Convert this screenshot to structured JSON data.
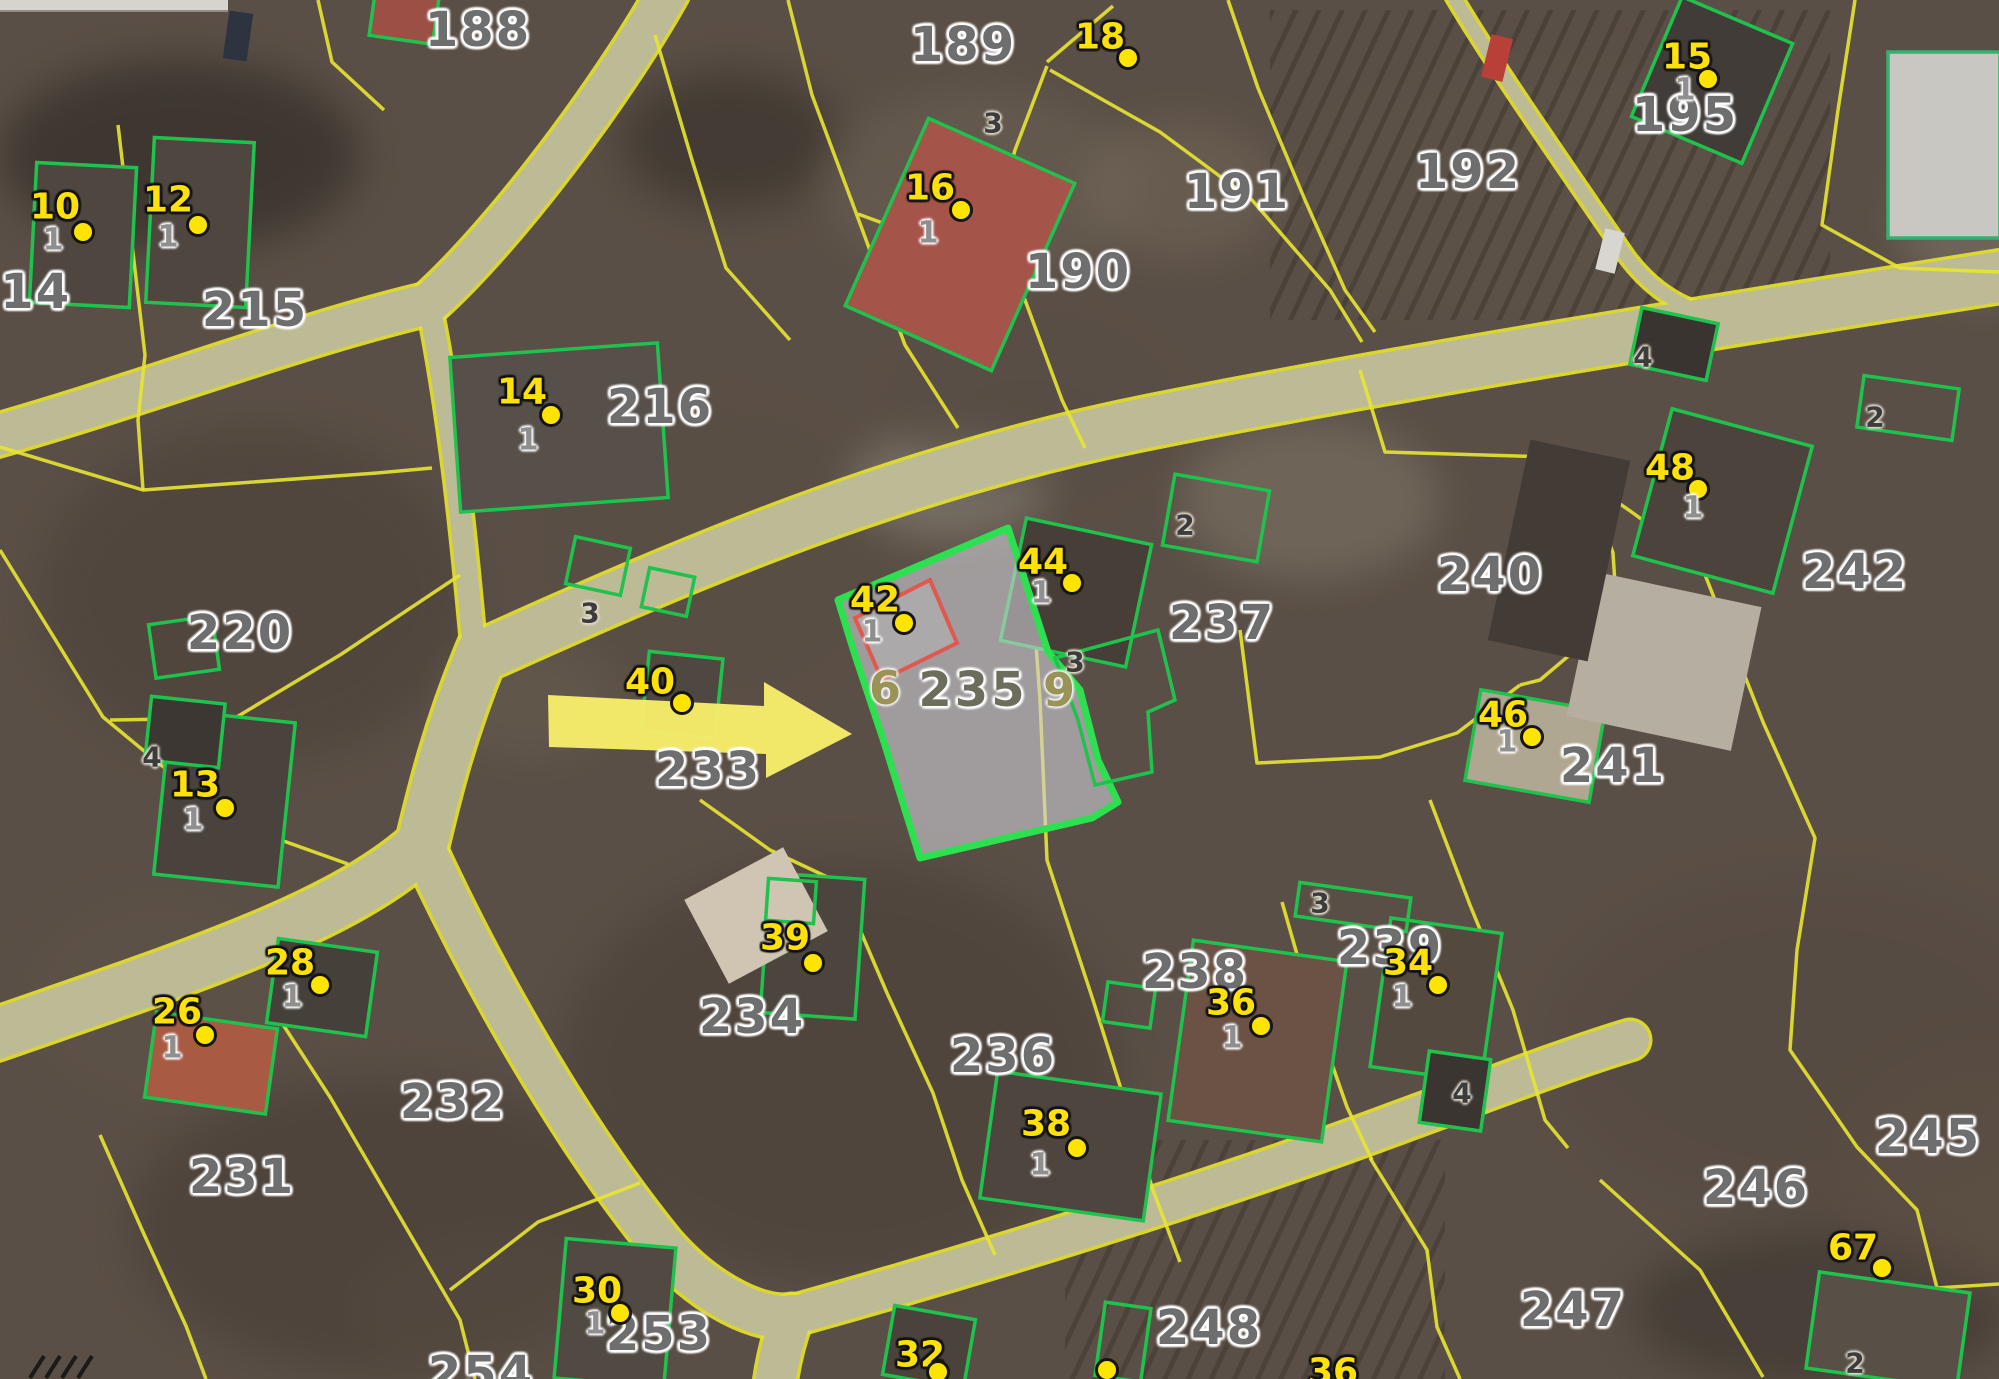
{
  "map": {
    "highlighted_parcel": {
      "number": "235",
      "ghost_left": "6",
      "ghost_right": "9",
      "x": 973,
      "y": 690
    },
    "parcel_labels": [
      {
        "text": "214",
        "x": 18,
        "y": 292
      },
      {
        "text": "215",
        "x": 255,
        "y": 310
      },
      {
        "text": "188",
        "x": 478,
        "y": 30
      },
      {
        "text": "189",
        "x": 963,
        "y": 45
      },
      {
        "text": "190",
        "x": 1078,
        "y": 272
      },
      {
        "text": "191",
        "x": 1237,
        "y": 192
      },
      {
        "text": "192",
        "x": 1468,
        "y": 172
      },
      {
        "text": "195",
        "x": 1685,
        "y": 115
      },
      {
        "text": "216",
        "x": 660,
        "y": 407
      },
      {
        "text": "220",
        "x": 240,
        "y": 633
      },
      {
        "text": "233",
        "x": 708,
        "y": 770
      },
      {
        "text": "237",
        "x": 1222,
        "y": 623
      },
      {
        "text": "240",
        "x": 1490,
        "y": 575
      },
      {
        "text": "241",
        "x": 1613,
        "y": 766
      },
      {
        "text": "242",
        "x": 1855,
        "y": 572
      },
      {
        "text": "232",
        "x": 453,
        "y": 1102
      },
      {
        "text": "231",
        "x": 242,
        "y": 1177
      },
      {
        "text": "234",
        "x": 752,
        "y": 1017
      },
      {
        "text": "236",
        "x": 1003,
        "y": 1056
      },
      {
        "text": "238",
        "x": 1195,
        "y": 972
      },
      {
        "text": "239",
        "x": 1390,
        "y": 948
      },
      {
        "text": "245",
        "x": 1928,
        "y": 1137
      },
      {
        "text": "246",
        "x": 1756,
        "y": 1188
      },
      {
        "text": "247",
        "x": 1573,
        "y": 1310
      },
      {
        "text": "248",
        "x": 1209,
        "y": 1328
      },
      {
        "text": "253",
        "x": 659,
        "y": 1334
      },
      {
        "text": "254",
        "x": 481,
        "y": 1374
      }
    ],
    "point_markers": [
      {
        "label": "10",
        "lx": 55,
        "ly": 207,
        "dx": 83,
        "dy": 232,
        "sub": "1",
        "sx": 53,
        "sy": 240
      },
      {
        "label": "12",
        "lx": 168,
        "ly": 200,
        "dx": 198,
        "dy": 225,
        "sub": "1",
        "sx": 168,
        "sy": 237
      },
      {
        "label": "13",
        "lx": 195,
        "ly": 785,
        "dx": 225,
        "dy": 808,
        "sub": "1",
        "sx": 193,
        "sy": 820
      },
      {
        "label": "14",
        "lx": 522,
        "ly": 392,
        "dx": 551,
        "dy": 415,
        "sub": "1",
        "sx": 528,
        "sy": 440
      },
      {
        "label": "15",
        "lx": 1687,
        "ly": 57,
        "dx": 1708,
        "dy": 79,
        "sub": "1",
        "sx": 1685,
        "sy": 90
      },
      {
        "label": "16",
        "lx": 930,
        "ly": 188,
        "dx": 961,
        "dy": 210,
        "sub": "1",
        "sx": 928,
        "sy": 233
      },
      {
        "label": "18",
        "lx": 1100,
        "ly": 37,
        "dx": 1128,
        "dy": 58
      },
      {
        "label": "26",
        "lx": 177,
        "ly": 1012,
        "dx": 205,
        "dy": 1035,
        "sub": "1",
        "sx": 172,
        "sy": 1048
      },
      {
        "label": "28",
        "lx": 290,
        "ly": 963,
        "dx": 320,
        "dy": 985,
        "sub": "1",
        "sx": 292,
        "sy": 997
      },
      {
        "label": "30",
        "lx": 597,
        "ly": 1291,
        "dx": 620,
        "dy": 1313,
        "sub": "1",
        "sx": 595,
        "sy": 1324
      },
      {
        "label": "32",
        "lx": 920,
        "ly": 1355,
        "dx": 938,
        "dy": 1372
      },
      {
        "label": "34",
        "lx": 1408,
        "ly": 963,
        "dx": 1438,
        "dy": 985,
        "sub": "1",
        "sx": 1402,
        "sy": 997
      },
      {
        "label": "36",
        "lx": 1231,
        "ly": 1003,
        "dx": 1261,
        "dy": 1026,
        "sub": "1",
        "sx": 1232,
        "sy": 1038
      },
      {
        "label": "36",
        "lx": 1333,
        "ly": 1372
      },
      {
        "label": "38",
        "lx": 1046,
        "ly": 1124,
        "dx": 1077,
        "dy": 1148,
        "sub": "1",
        "sx": 1040,
        "sy": 1165
      },
      {
        "label": "39",
        "lx": 785,
        "ly": 938,
        "dx": 813,
        "dy": 963
      },
      {
        "label": "40",
        "lx": 650,
        "ly": 682,
        "dx": 682,
        "dy": 703
      },
      {
        "label": "42",
        "lx": 875,
        "ly": 600,
        "dx": 904,
        "dy": 623,
        "sub": "1",
        "sx": 872,
        "sy": 632
      },
      {
        "label": "44",
        "lx": 1043,
        "ly": 562,
        "dx": 1072,
        "dy": 583,
        "sub": "1",
        "sx": 1041,
        "sy": 593
      },
      {
        "label": "46",
        "lx": 1503,
        "ly": 715,
        "dx": 1532,
        "dy": 737,
        "sub": "1",
        "sx": 1507,
        "sy": 742
      },
      {
        "label": "48",
        "lx": 1670,
        "ly": 468,
        "dx": 1698,
        "dy": 489,
        "sub": "1",
        "sx": 1693,
        "sy": 508
      },
      {
        "label": "67",
        "lx": 1853,
        "ly": 1248,
        "dx": 1882,
        "dy": 1268
      }
    ],
    "extra_dots": [
      {
        "x": 1107,
        "y": 1370
      }
    ],
    "small_labels": [
      {
        "text": "3",
        "x": 993,
        "y": 123
      },
      {
        "text": "3",
        "x": 590,
        "y": 613
      },
      {
        "text": "3",
        "x": 1075,
        "y": 662
      },
      {
        "text": "3",
        "x": 1320,
        "y": 903
      },
      {
        "text": "2",
        "x": 1185,
        "y": 525
      },
      {
        "text": "2",
        "x": 1875,
        "y": 417
      },
      {
        "text": "2",
        "x": 1855,
        "y": 1363
      },
      {
        "text": "4",
        "x": 1643,
        "y": 357
      },
      {
        "text": "4",
        "x": 152,
        "y": 757
      },
      {
        "text": "4",
        "x": 1462,
        "y": 1093
      }
    ],
    "colors": {
      "parcel_boundary": "#e8e432",
      "building_outline": "#1fc24c",
      "highlight_outline": "#2ce04f",
      "highlight_fill": "rgba(206,207,213,0.6)",
      "road_fill": "#bdbb95",
      "marker_yellow": "#ffe10a",
      "parcel_text_gray": "#6e6e6e",
      "red_building_outline": "#e0584e",
      "arrow_yellow": "#f6ec6a"
    }
  }
}
